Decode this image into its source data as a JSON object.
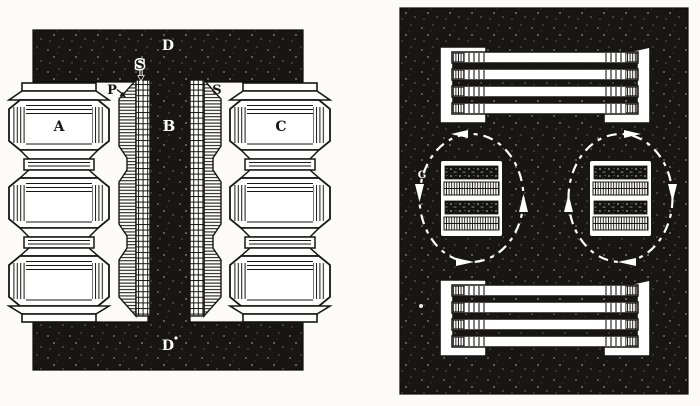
{
  "colors": {
    "ink": "#171614",
    "paper": "#fcfbf9",
    "white": "#ffffff"
  },
  "figure_left": {
    "labels": {
      "yoke_top": "D",
      "yoke_bottom": "D",
      "core_limb": "B",
      "coil_left": "A",
      "coil_right": "C",
      "primary_winding": "P",
      "secondary_winding_top": "S",
      "secondary_winding_right": "S"
    }
  },
  "figure_right": {
    "labels": {
      "flux_mark": "G"
    }
  }
}
